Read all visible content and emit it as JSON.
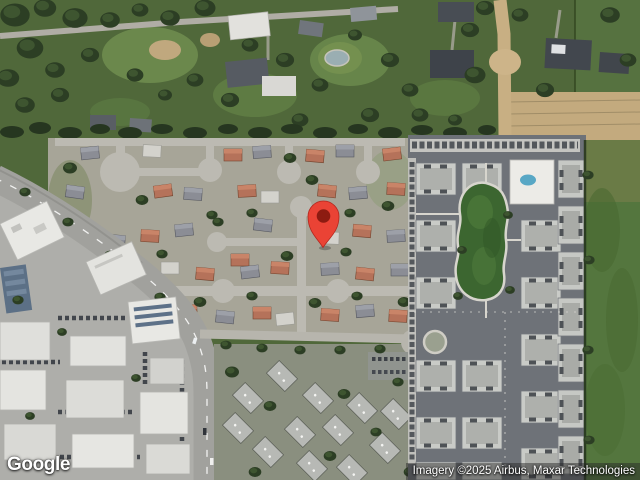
{
  "map": {
    "view_label": "Satellite map view",
    "logo": "Google",
    "attribution": "Imagery ©2025 Airbus, Maxar Technologies",
    "marker": {
      "name": "location-pin",
      "fill": "#EA4335",
      "outline": "#B3271E",
      "inner": "#8D1B11"
    },
    "palette": {
      "vegetation_dark": "#2c3e24",
      "grass": "#6b884c",
      "field_green": "#54763e",
      "dirt_tan": "#c8af83",
      "suburb_road": "#bcbab2",
      "arterial_road": "#a1a19d",
      "complex_road": "#6e7278",
      "roof_terracotta": "#b5725a",
      "roof_gray": "#8b8d95",
      "roof_white": "#e7e7e3"
    }
  }
}
